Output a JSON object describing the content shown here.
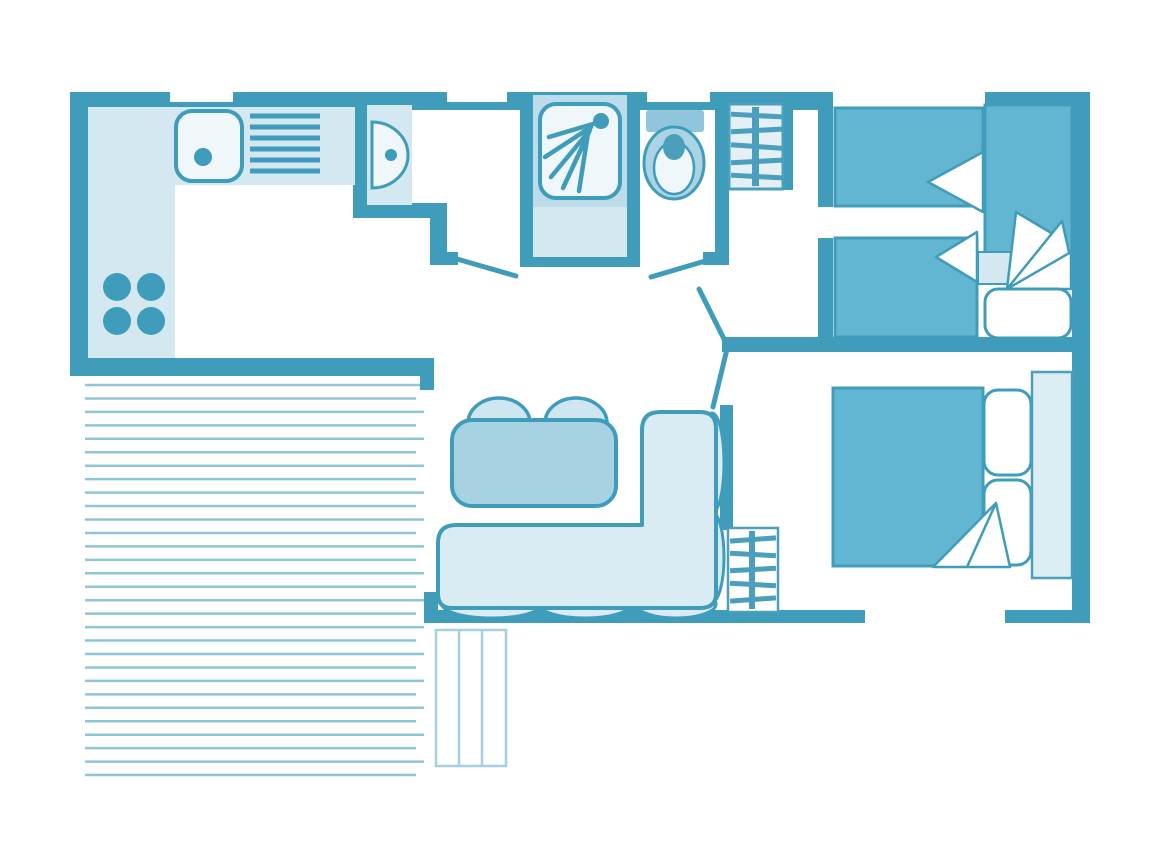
{
  "page": {
    "title": "Mobile home floor plan",
    "background": "#ffffff"
  },
  "colors": {
    "wall": "#3F9CBA",
    "surfaceLight": "#D3E8F1",
    "surfaceLighter": "#EFF7FB",
    "showerSurround": "#BCDCEA",
    "furnitureMedium": "#63B6D1",
    "toiletTank": "#8FC6DC",
    "toiletBowl": "#AAD4E4",
    "toiletSeatDot": "#4A9FBC",
    "tableFill": "#A6D2E2",
    "chairFill": "#CDE6F0",
    "sofaFill": "#D9ECF4",
    "terracePlank": "#8FC5D8",
    "stepsLine": "#A6CFDF",
    "shelfFill": "#E4F0F6",
    "shelfLine": "#4A9FBC",
    "headboardFill": "#DCEDF4",
    "pillow": "#FFFFFF"
  },
  "terrace": {
    "plank_count": 30,
    "plank_start_y": 385,
    "plank_spacing": 13.45,
    "step_count": 3
  },
  "elements": [
    "kitchen-counter",
    "kitchen-sink",
    "sink-drainer",
    "hob-burners",
    "washbasin",
    "shower",
    "shower-mat",
    "toilet",
    "wardrobe-shelf-hall",
    "wardrobe-shelf-living",
    "single-bed-top",
    "single-bed-middle",
    "single-bed-vertical",
    "double-bed",
    "pillows",
    "folded-blanket",
    "headboard-shelf",
    "dining-table",
    "dining-chairs",
    "corner-sofa",
    "terrace-deck",
    "terrace-steps",
    "door-swings",
    "window-openings"
  ]
}
